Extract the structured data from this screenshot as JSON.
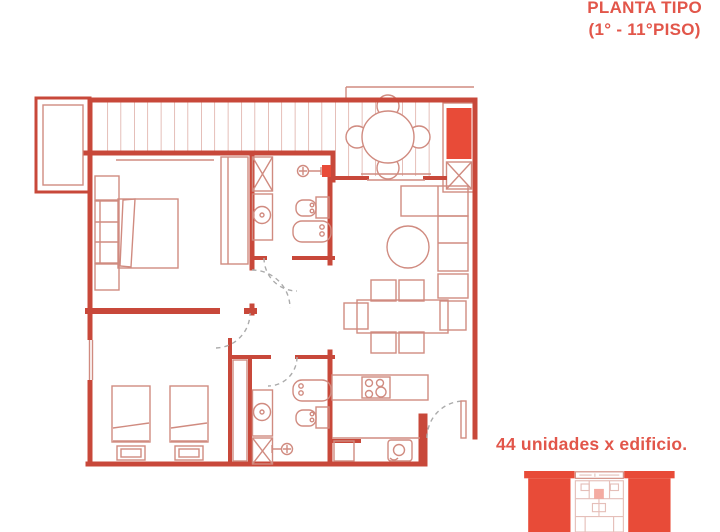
{
  "header": {
    "title_line1": "PLANTA TIPO",
    "title_line2": "(1° - 11°PISO)"
  },
  "caption": {
    "text": "44 unidades x edificio."
  },
  "colors": {
    "accent_red": "#e2564a",
    "wall_red": "#c8483a",
    "furniture_red": "#d08b80",
    "fill_red": "#e84b38",
    "door_dash_gray": "#ababab"
  }
}
